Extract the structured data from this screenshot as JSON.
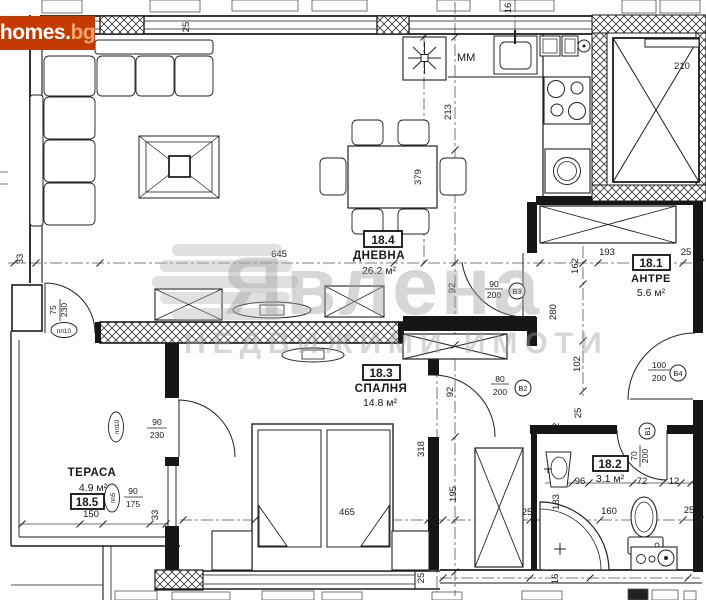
{
  "branding": {
    "logo_main": "homes",
    "logo_dot": ".",
    "logo_tld": "bg",
    "logo_bg_color": "#c43a00"
  },
  "watermark": {
    "brand": "Явлена",
    "tagline": "НЕДВИЖИМИ ИМОТИ",
    "color": "#c9c9c9"
  },
  "rooms": {
    "living": {
      "id": "18.4",
      "name": "ДНЕВНА",
      "area": "26.2 м²"
    },
    "hall": {
      "id": "18.1",
      "name": "АНТРЕ",
      "area": "5.6 м²"
    },
    "bedroom": {
      "id": "18.3",
      "name": "СПАЛНЯ",
      "area": "14.8 м²"
    },
    "bath": {
      "id": "18.2",
      "area": "3.1 м²"
    },
    "terrace": {
      "id": "18.5",
      "name": "ТЕРАСА",
      "area": "4.9 м²"
    }
  },
  "doors": {
    "b1": {
      "width": "70",
      "height": "200",
      "code": "В1"
    },
    "b2": {
      "width": "80",
      "height": "200",
      "code": "В2"
    },
    "b3": {
      "width": "90",
      "height": "200",
      "code": "В3"
    },
    "b4": {
      "width": "100",
      "height": "200",
      "code": "В4"
    },
    "pp10_living": {
      "width": "75",
      "height": "230",
      "code": "пп10"
    },
    "pp10_bedroom": {
      "width": "90",
      "height": "230",
      "code": "пп10"
    },
    "pp5_window": {
      "width": "90",
      "height": "175",
      "code": "пп5"
    }
  },
  "kitchen": {
    "appliance_label": "MM"
  },
  "plan": {
    "dim_labels": [
      {
        "t": "25",
        "x": 189,
        "y": 27,
        "r": 1
      },
      {
        "t": "16",
        "x": 511,
        "y": 8,
        "r": 1
      },
      {
        "t": "210",
        "x": 682,
        "y": 69
      },
      {
        "t": "213",
        "x": 451,
        "y": 112,
        "r": 1
      },
      {
        "t": "379",
        "x": 421,
        "y": 177,
        "r": 1
      },
      {
        "t": "645",
        "x": 279,
        "y": 257
      },
      {
        "t": "193",
        "x": 607,
        "y": 255
      },
      {
        "t": "25",
        "x": 686,
        "y": 255
      },
      {
        "t": "162",
        "x": 578,
        "y": 266,
        "r": 1
      },
      {
        "t": "280",
        "x": 556,
        "y": 312,
        "r": 1
      },
      {
        "t": "102",
        "x": 580,
        "y": 364,
        "r": 1
      },
      {
        "t": "92",
        "x": 455,
        "y": 288,
        "r": 1
      },
      {
        "t": "92",
        "x": 453,
        "y": 392,
        "r": 1
      },
      {
        "t": "465",
        "x": 347,
        "y": 515
      },
      {
        "t": "318",
        "x": 424,
        "y": 449,
        "r": 1
      },
      {
        "t": "195",
        "x": 456,
        "y": 494,
        "r": 1
      },
      {
        "t": "25",
        "x": 424,
        "y": 578,
        "r": 1
      },
      {
        "t": "96",
        "x": 580,
        "y": 484
      },
      {
        "t": "72",
        "x": 642,
        "y": 484
      },
      {
        "t": "12",
        "x": 674,
        "y": 484
      },
      {
        "t": "183",
        "x": 559,
        "y": 502,
        "r": 1
      },
      {
        "t": "160",
        "x": 609,
        "y": 514
      },
      {
        "t": "25",
        "x": 689,
        "y": 513
      },
      {
        "t": "150",
        "x": 91,
        "y": 517
      },
      {
        "t": "33",
        "x": 158,
        "y": 515,
        "r": 1
      },
      {
        "t": "33",
        "x": 23,
        "y": 259,
        "r": 1
      },
      {
        "t": "16",
        "x": 558,
        "y": 579,
        "r": 1
      },
      {
        "t": "25",
        "x": 527,
        "y": 515
      },
      {
        "t": "12",
        "x": 559,
        "y": 428,
        "r": 1
      },
      {
        "t": "25",
        "x": 581,
        "y": 413,
        "r": 1
      }
    ]
  }
}
